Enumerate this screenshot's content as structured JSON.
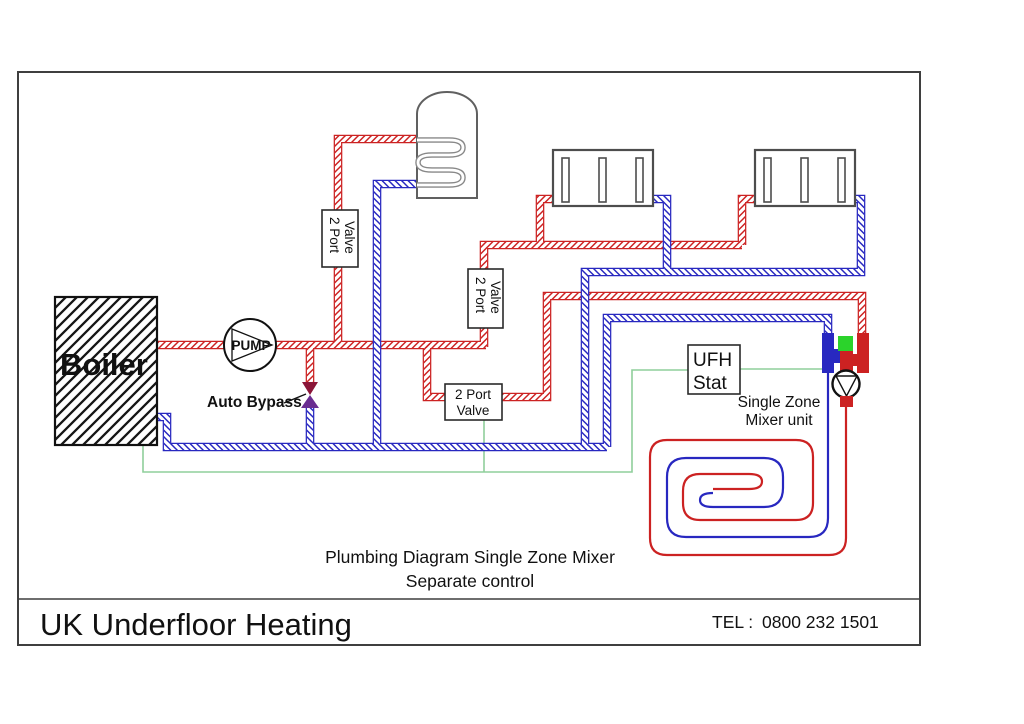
{
  "colors": {
    "pipe_red": "#cc2222",
    "pipe_blue": "#2828c0",
    "wire_green": "#8fcf9b",
    "mixer_green": "#2bd32b",
    "bypass_top": "#8b1538",
    "bypass_bottom": "#6a2d91"
  },
  "boiler": {
    "label": "Boiler"
  },
  "pump": {
    "label": "PUMP"
  },
  "auto_bypass": {
    "label": "Auto Bypass"
  },
  "valve": {
    "line1": "2 Port",
    "line2": "Valve"
  },
  "ufh_stat": {
    "line1": "UFH",
    "line2": "Stat"
  },
  "mixer": {
    "line1": "Single Zone",
    "line2": "Mixer unit"
  },
  "caption": {
    "line1": "Plumbing Diagram Single Zone Mixer",
    "line2": "Separate control"
  },
  "footer": {
    "company": "UK Underfloor Heating",
    "tel_label": "TEL :",
    "tel_number": "0800 232 1501"
  }
}
